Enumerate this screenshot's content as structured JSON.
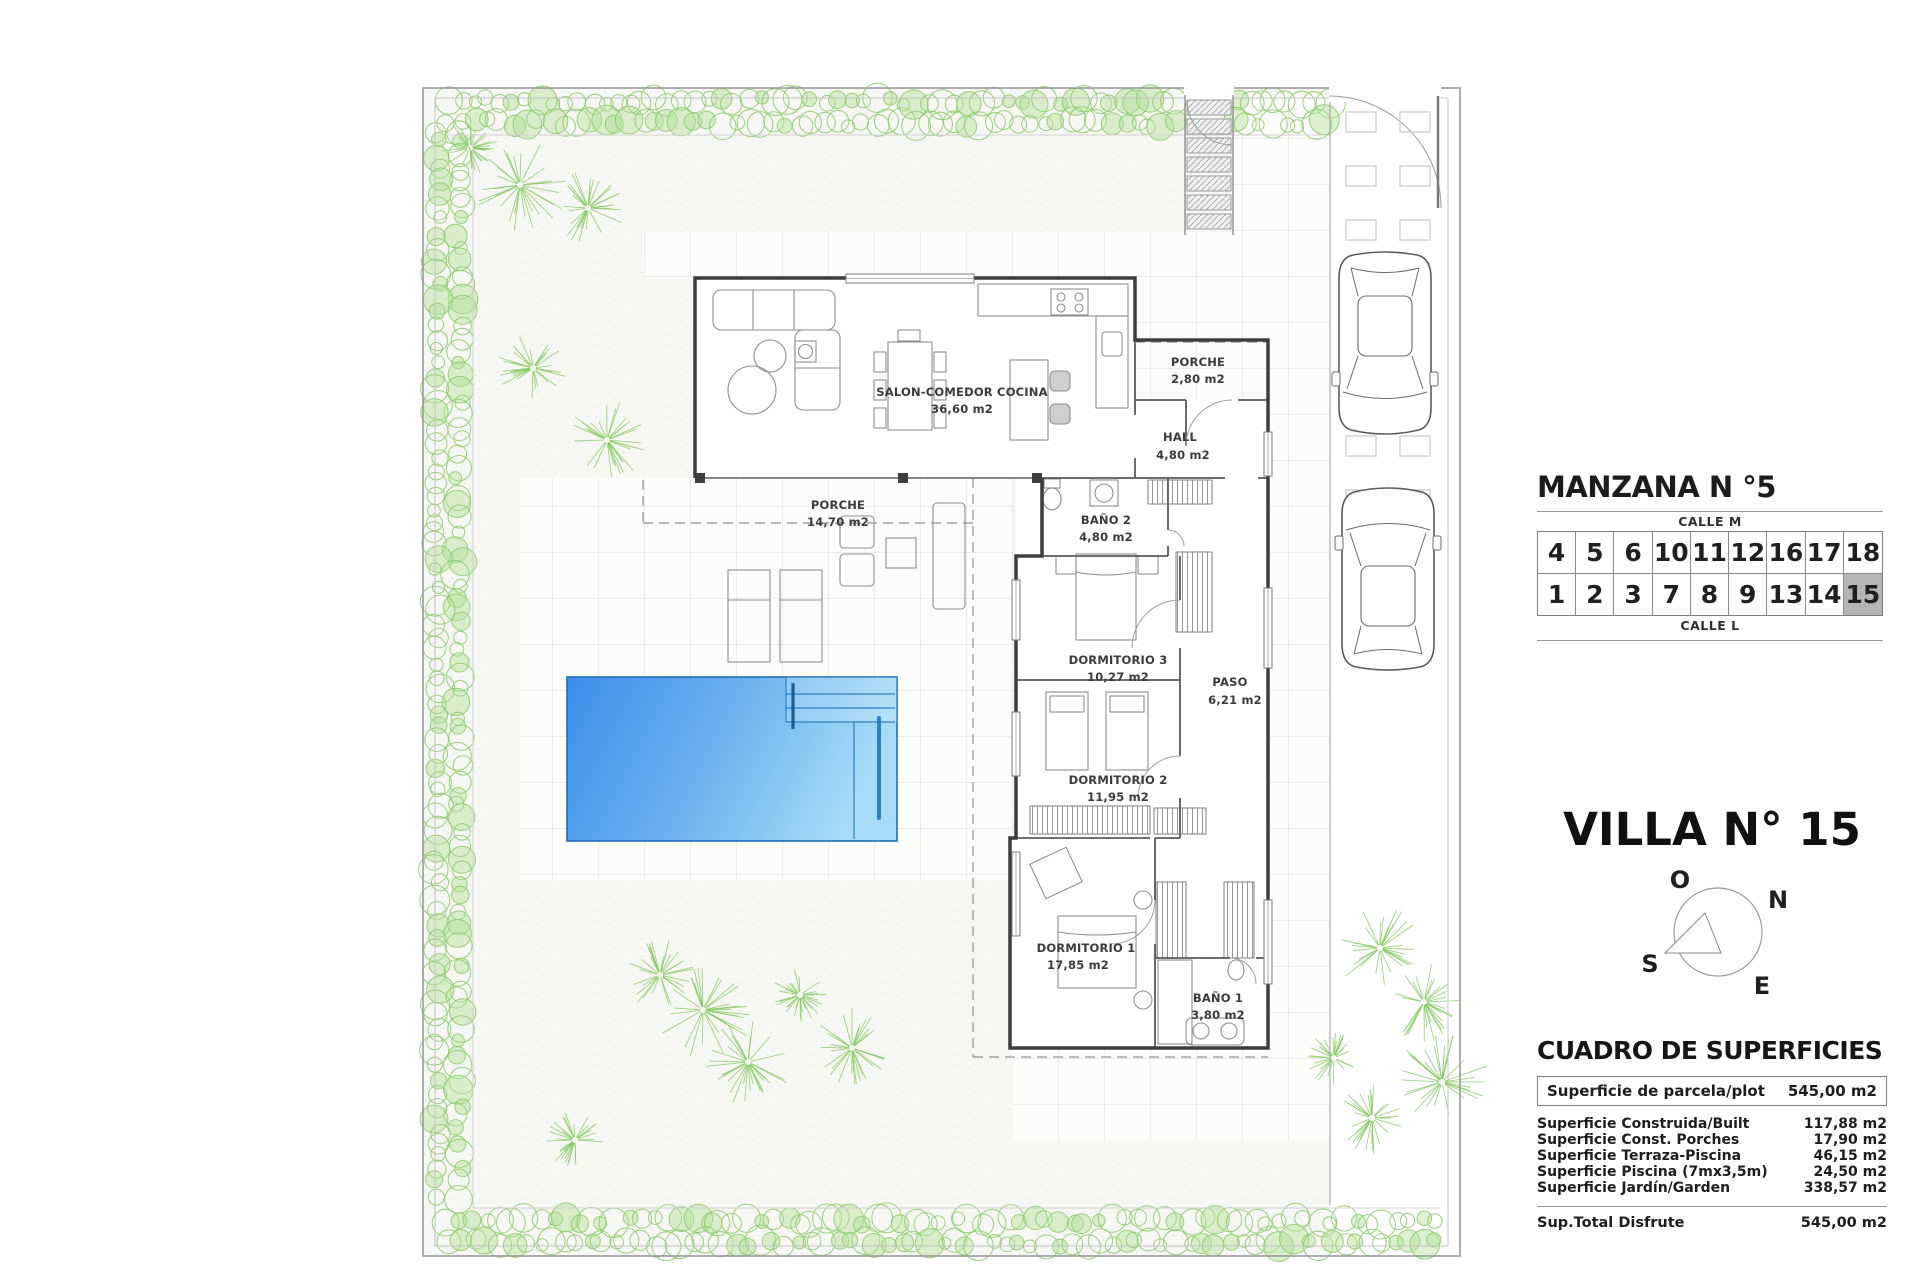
{
  "plan": {
    "rooms": [
      {
        "name": "SALON-COMEDOR COCINA",
        "area": "36,60 m2"
      },
      {
        "name": "PORCHE",
        "area": "2,80 m2"
      },
      {
        "name": "HALL",
        "area": "4,80 m2"
      },
      {
        "name": "PORCHE",
        "area": "14,70 m2"
      },
      {
        "name": "BAÑO 2",
        "area": "4,80 m2"
      },
      {
        "name": "DORMITORIO 3",
        "area": "10,27 m2"
      },
      {
        "name": "PASO",
        "area": "6,21 m2"
      },
      {
        "name": "DORMITORIO 2",
        "area": "11,95 m2"
      },
      {
        "name": "DORMITORIO 1",
        "area": "17,85 m2"
      },
      {
        "name": "BAÑO 1",
        "area": "3,80 m2"
      }
    ],
    "colors": {
      "pool_dark": "#3c8ceb",
      "pool_light": "#a6dcf7",
      "vegetation": "#8bcb6d",
      "walls": "#3d3d3d",
      "tiles": "#dcdcdc"
    }
  },
  "block_panel": {
    "title": "MANZANA N °5",
    "street_top": "CALLE M",
    "street_bottom": "CALLE L",
    "row_top": [
      "4",
      "5",
      "6",
      "10",
      "11",
      "12",
      "16",
      "17",
      "18"
    ],
    "row_bottom": [
      "1",
      "2",
      "3",
      "7",
      "8",
      "9",
      "13",
      "14",
      "15"
    ],
    "highlighted_lot": "15"
  },
  "villa": {
    "title": "VILLA N° 15"
  },
  "compass": {
    "west": "O",
    "north": "N",
    "south": "S",
    "east": "E"
  },
  "surfaces": {
    "title": "CUADRO DE SUPERFICIES",
    "plot_row": {
      "label": "Superficie de parcela/plot",
      "value": "545,00 m2"
    },
    "rows": [
      {
        "label": "Superficie Construida/Built",
        "value": "117,88 m2"
      },
      {
        "label": "Superficie Const. Porches",
        "value": "17,90 m2"
      },
      {
        "label": "Superficie Terraza-Piscina",
        "value": "46,15 m2"
      },
      {
        "label": "Superficie Piscina (7mx3,5m)",
        "value": "24,50 m2"
      },
      {
        "label": "Superficie Jardín/Garden",
        "value": "338,57 m2"
      }
    ],
    "total_row": {
      "label": "Sup.Total Disfrute",
      "value": "545,00 m2"
    }
  }
}
